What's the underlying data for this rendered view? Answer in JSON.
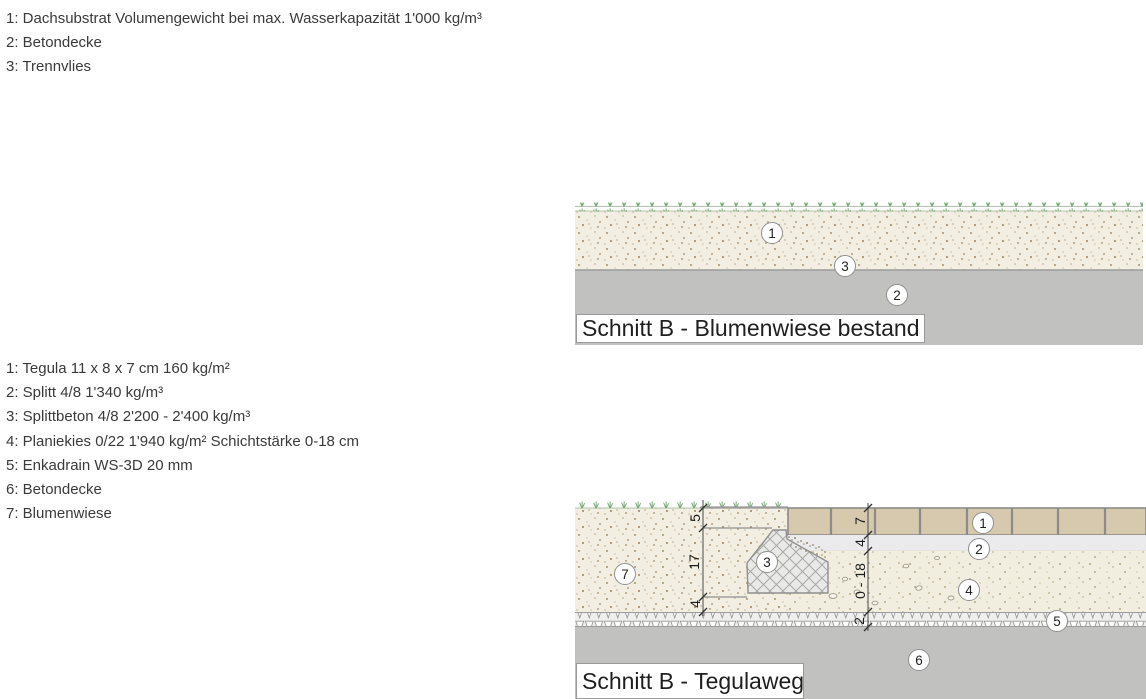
{
  "legend_blumenwiese": {
    "items": [
      "1: Dachsubstrat Volumengewicht bei max. Wasserkapazität 1'000 kg/m³",
      "2: Betondecke",
      "3: Trennvlies"
    ]
  },
  "legend_tegulaweg": {
    "items": [
      "1: Tegula 11 x 8 x 7 cm 160 kg/m²",
      "2: Splitt 4/8 1'340 kg/m³",
      "3: Splittbeton 4/8 2'200 - 2'400 kg/m³",
      "4: Planiekies 0/22 1'940 kg/m² Schichtstärke 0-18 cm",
      "5: Enkadrain WS-3D 20 mm",
      "6: Betondecke",
      "7: Blumenwiese"
    ]
  },
  "diagram_blumenwiese": {
    "title": "Schnitt B - Blumenwiese bestand",
    "markers": [
      "1",
      "3",
      "2"
    ]
  },
  "diagram_tegulaweg": {
    "title": "Schnitt B - Tegulaweg",
    "markers": [
      "7",
      "3",
      "1",
      "2",
      "4",
      "5",
      "6"
    ],
    "dims_left": [
      "5",
      "17",
      "4"
    ],
    "dims_right": [
      "7",
      "4",
      "0 - 18",
      "2"
    ]
  },
  "colors": {
    "substrate": "#f2efe2",
    "substrate_speckle": "#b5a07e",
    "concrete": "#c1c1c0",
    "paver": "#d7c9ae",
    "splitt": "#ebebee",
    "grass": "#79a879",
    "line_gray": "#8f8f8f",
    "text": "#3a3a3a"
  }
}
